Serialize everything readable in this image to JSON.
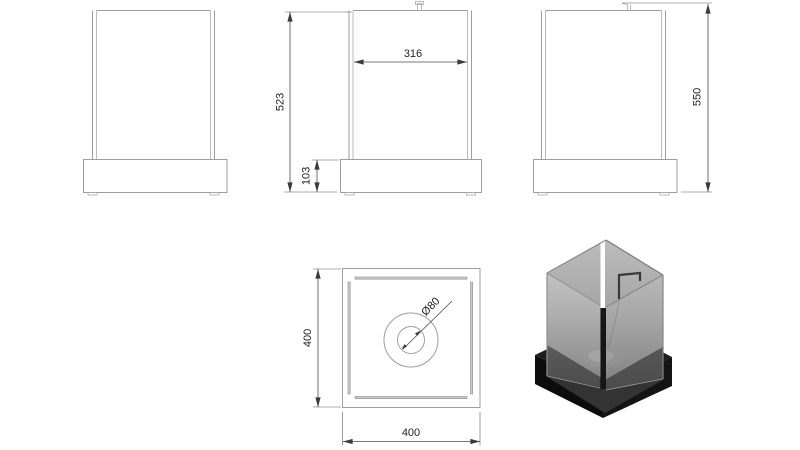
{
  "page": {
    "background": "#ffffff"
  },
  "drawing": {
    "object_line_color": "#9e9e9e",
    "dimension_line_color": "#4a4a4a",
    "text_color": "#1f1f1f",
    "dimensions": {
      "overall_height": "550",
      "body_height": "523",
      "glass_width": "316",
      "base_height": "103",
      "plan_depth": "400",
      "plan_width": "400",
      "burner_diameter": "Ø80"
    },
    "render": {
      "base_color": "#111111",
      "glass_color": "#a8a8a8",
      "burner_color": "#8e8e8e"
    }
  }
}
